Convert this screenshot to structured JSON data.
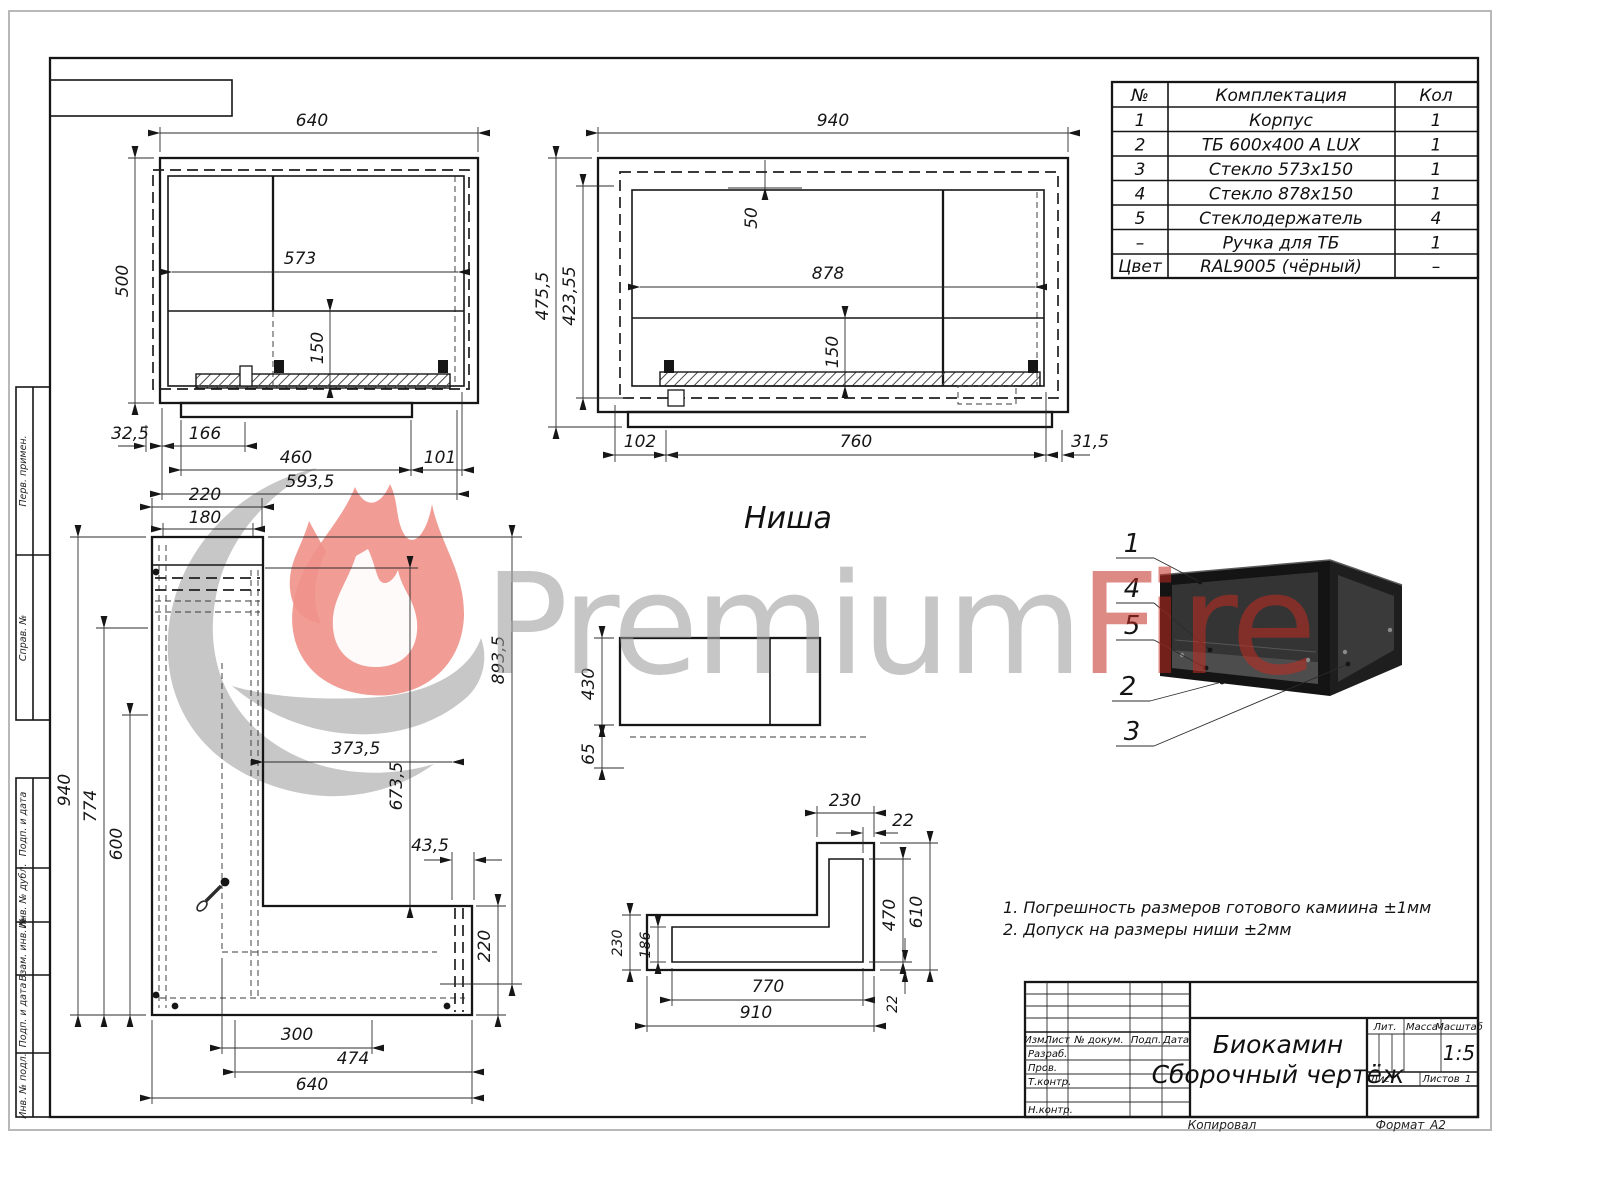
{
  "watermark": {
    "premium": "Premium",
    "fire": "Fire"
  },
  "labels": {
    "niche": "Ниша"
  },
  "notes": {
    "n1": "1. Погрешность размеров готового камиина ±1мм",
    "n2": "2. Допуск на размеры ниши ±2мм"
  },
  "side_stamp": {
    "cells": [
      "Перв. примен.",
      "Справ. №",
      "Подп. и дата",
      "Инв. № дубл.",
      "Взам. инв. №",
      "Подп. и дата",
      "Инв. № подл."
    ]
  },
  "parts_table": {
    "headers": {
      "no": "№",
      "name": "Комплектация",
      "qty": "Кол"
    },
    "rows": [
      {
        "no": "1",
        "name": "Корпус",
        "qty": "1"
      },
      {
        "no": "2",
        "name": "ТБ 600х400 А LUX",
        "qty": "1"
      },
      {
        "no": "3",
        "name": "Стекло 573х150",
        "qty": "1"
      },
      {
        "no": "4",
        "name": "Стекло 878х150",
        "qty": "1"
      },
      {
        "no": "5",
        "name": "Стеклодержатель",
        "qty": "4"
      },
      {
        "no": "–",
        "name": "Ручка для ТБ",
        "qty": "1"
      },
      {
        "no": "Цвет",
        "name": "RAL9005 (чёрный)",
        "qty": "–"
      }
    ]
  },
  "title_block": {
    "rev_headers": {
      "izm": "Изм.",
      "list": "Лист",
      "dokum": "№ докум.",
      "podp": "Подп.",
      "data": "Дата"
    },
    "roles": {
      "razrab": "Разраб.",
      "prov": "Пров.",
      "tkontr": "Т.контр.",
      "nkontr": "Н.контр.",
      "utv": "Утв."
    },
    "doc_title_1": "Биокамин",
    "doc_title_2": "Сборочный чертёж",
    "lit": "Лит.",
    "massa": "Масса",
    "masshtab": "Масштаб",
    "scale": "1:5",
    "list_label": "Лист",
    "listov_label": "Листов",
    "listov_value": "1",
    "kopiroval": "Копировал",
    "format_label": "Формат",
    "format_value": "А2"
  },
  "callouts": {
    "c1": "1",
    "c4": "4",
    "c5": "5",
    "c2": "2",
    "c3": "3"
  },
  "dims": {
    "f1_w": "640",
    "f1_h": "500",
    "f1_glass_w": "573",
    "f1_glass_h": "150",
    "f1_b1": "32,5",
    "f1_b2": "166",
    "f1_b3": "460",
    "f1_b4": "101",
    "f1_total": "593,5",
    "f2_w": "940",
    "f2_h1": "475,5",
    "f2_h2": "423,55",
    "f2_top": "50",
    "f2_glass_w": "878",
    "f2_glass_h": "150",
    "f2_b1": "102",
    "f2_b2": "760",
    "f2_b3": "31,5",
    "p_leg_outer": "220",
    "p_leg_inner": "180",
    "p_h": "940",
    "p_h2": "774",
    "p_h3": "600",
    "p_niche_h": "893,5",
    "p_open_h": "673,5",
    "p_open_w": "373,5",
    "p_gap": "43,5",
    "p_leg_h": "220",
    "p_b1": "300",
    "p_b2": "474",
    "p_b3": "640",
    "ns_h": "430",
    "ns_off": "65",
    "np_top": "230",
    "np_wall_t": "22",
    "np_right": "610",
    "np_inner_h": "470",
    "np_inner_l": "186",
    "np_left": "230",
    "np_inner_w": "770",
    "np_bottom": "910",
    "np_wall_b": "22"
  }
}
